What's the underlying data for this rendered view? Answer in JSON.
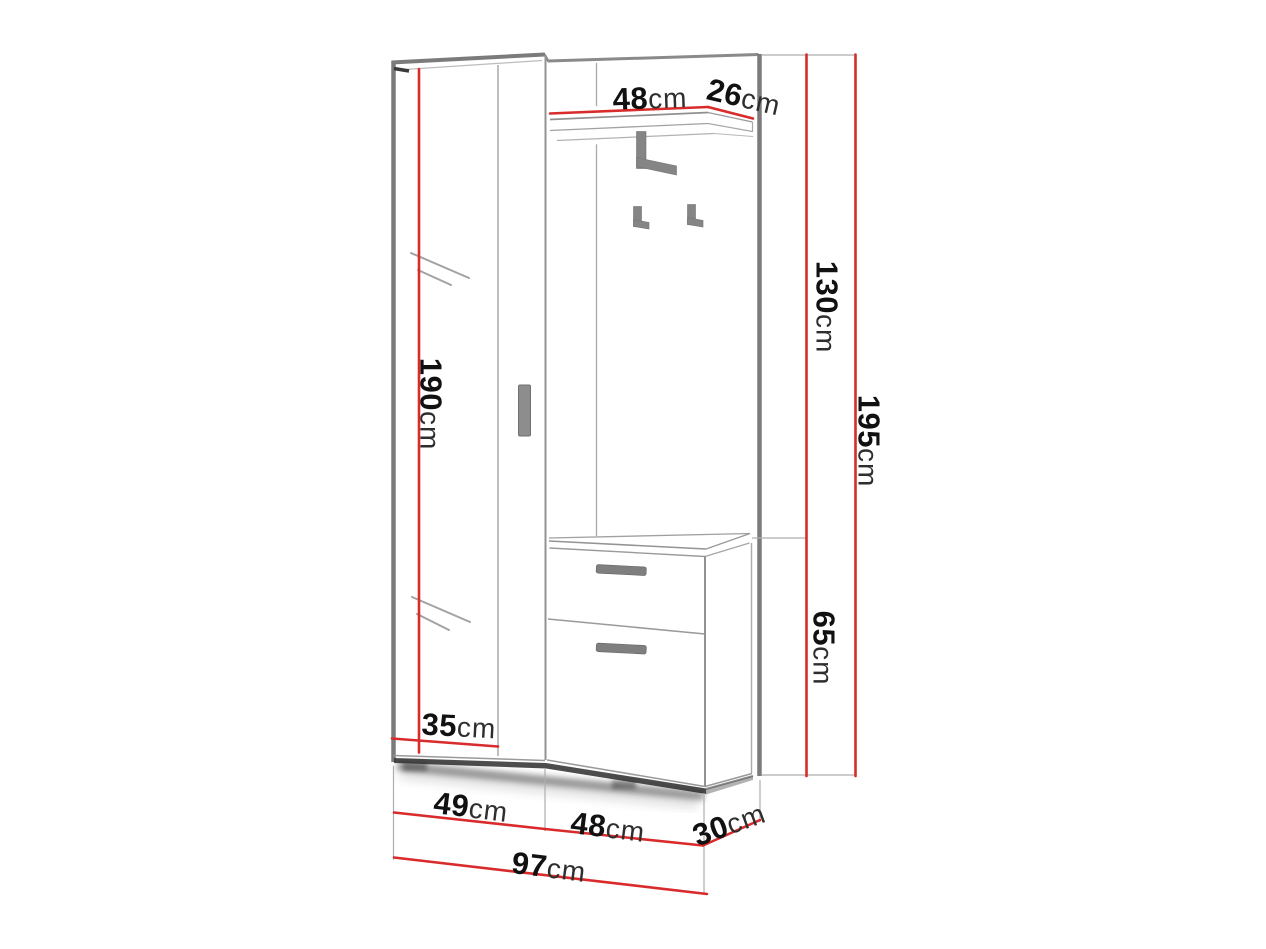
{
  "colors": {
    "dimension_line_red": "#d92b2b",
    "outline_gray": "#8a8a8a",
    "hardware_gray": "#858585",
    "text_black": "#111111",
    "background": "#ffffff"
  },
  "furniture_diagram": {
    "dimensions": {
      "shelf_width": {
        "value": "48",
        "unit": "cm"
      },
      "shelf_depth": {
        "value": "26",
        "unit": "cm"
      },
      "hook_panel_height": {
        "value": "130",
        "unit": "cm"
      },
      "total_height": {
        "value": "195",
        "unit": "cm"
      },
      "mirror_door_height": {
        "value": "190",
        "unit": "cm"
      },
      "shoe_cabinet_height": {
        "value": "65",
        "unit": "cm"
      },
      "door_width": {
        "value": "35",
        "unit": "cm"
      },
      "left_section_width": {
        "value": "49",
        "unit": "cm"
      },
      "right_section_width": {
        "value": "48",
        "unit": "cm"
      },
      "depth": {
        "value": "30",
        "unit": "cm"
      },
      "total_width": {
        "value": "97",
        "unit": "cm"
      }
    }
  }
}
